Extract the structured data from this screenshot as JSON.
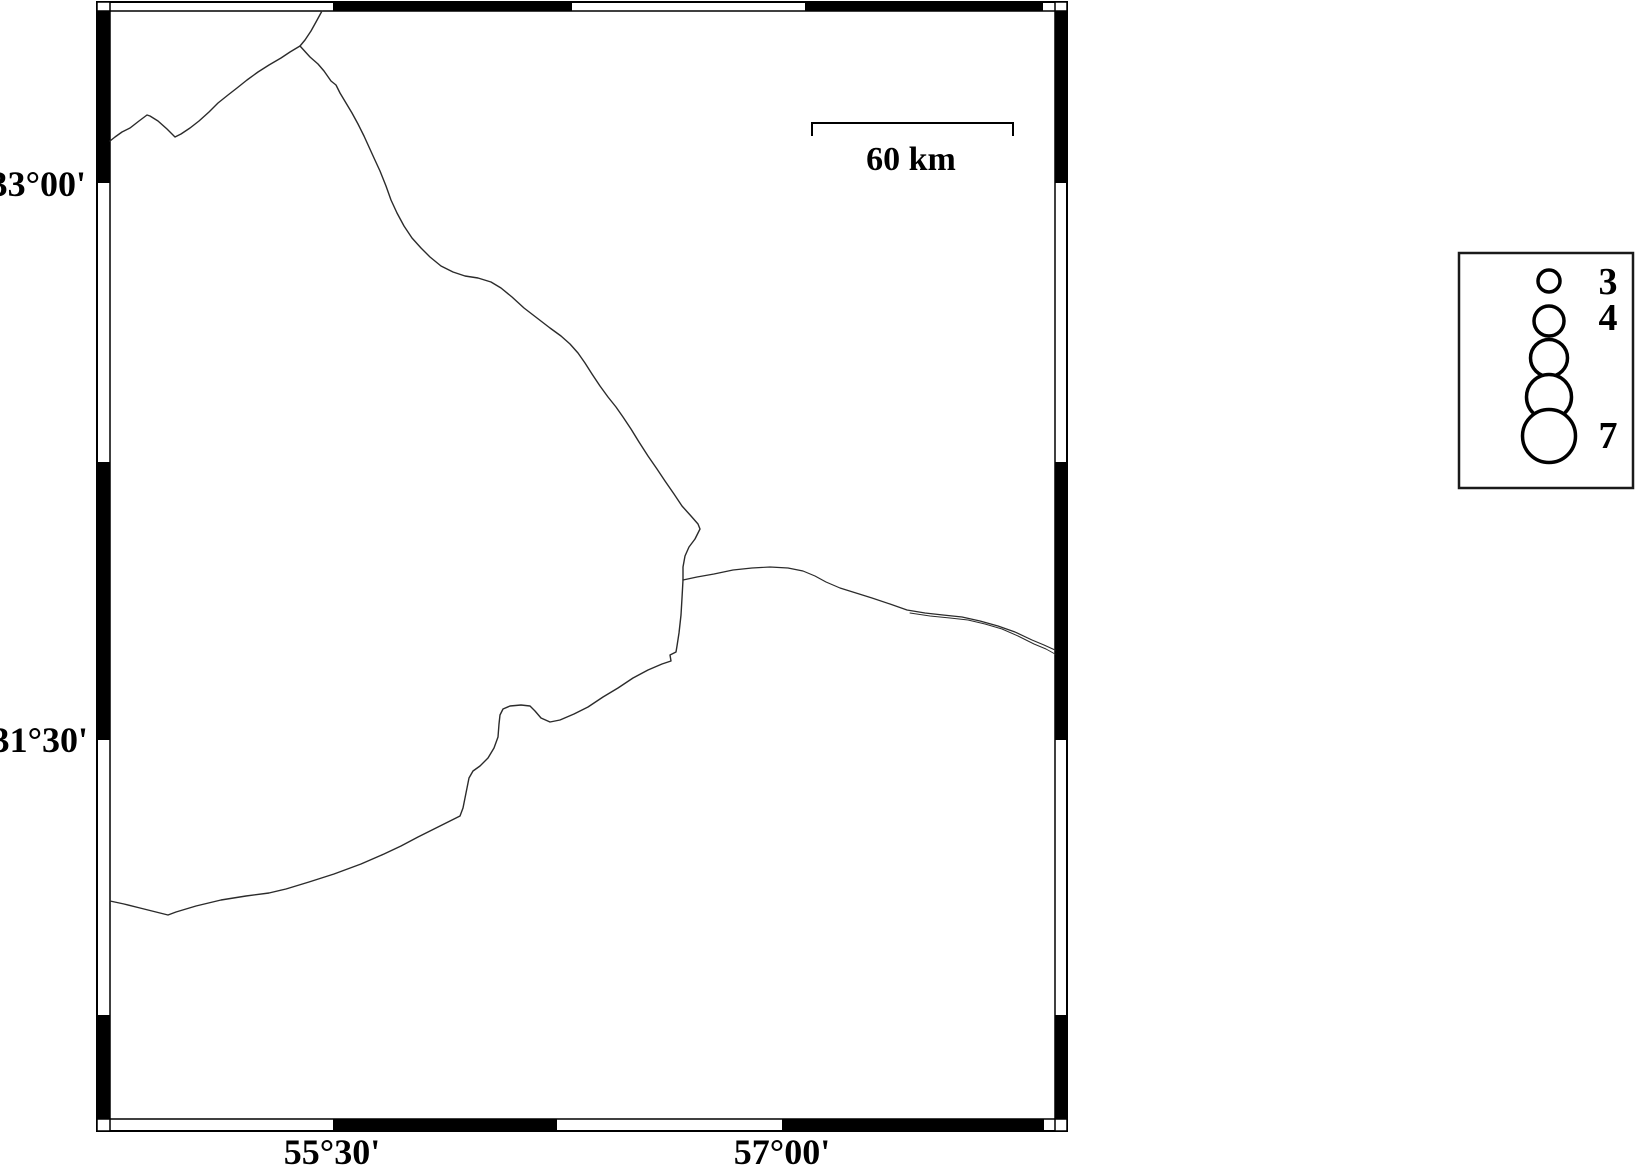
{
  "figure": {
    "width": 1639,
    "height": 1168,
    "background": "#ffffff",
    "frame_color": "#000000",
    "boundary_line_color": "#2b2b2b"
  },
  "map": {
    "frame": {
      "outer": {
        "x1": 97,
        "y1": 2,
        "x2": 1067,
        "y2": 1131
      },
      "inner": {
        "x1": 110,
        "y1": 11,
        "x2": 1055,
        "y2": 1119
      },
      "top_black_segments": [
        [
          333,
          572
        ],
        [
          805,
          1043
        ]
      ],
      "bottom_black_segments": [
        [
          333,
          557
        ],
        [
          782,
          1044
        ]
      ],
      "left_black_segments": [
        [
          11,
          183
        ],
        [
          462,
          740
        ],
        [
          1015,
          1119
        ]
      ],
      "right_black_segments": [
        [
          11,
          183
        ],
        [
          462,
          740
        ],
        [
          1015,
          1119
        ]
      ]
    },
    "graticule_labels": {
      "latitude": [
        {
          "text": "33°00'",
          "anchor_x": 86,
          "baseline_y": 196
        },
        {
          "text": "31°30'",
          "anchor_x": 88,
          "baseline_y": 752
        }
      ],
      "longitude": [
        {
          "text": "55°30'",
          "center_x": 332,
          "baseline_y": 1164
        },
        {
          "text": "57°00'",
          "center_x": 782,
          "baseline_y": 1164
        }
      ]
    },
    "scale_bar": {
      "label": "60 km",
      "x1": 812,
      "x2": 1013,
      "y": 123,
      "tick_drop": 13,
      "label_center_x": 911,
      "label_baseline_y": 170
    },
    "boundaries": {
      "northwest_line": [
        [
          322,
          11
        ],
        [
          316,
          22
        ],
        [
          311,
          31
        ],
        [
          305,
          40
        ],
        [
          300,
          46
        ],
        [
          290,
          52
        ],
        [
          281,
          58
        ],
        [
          269,
          65
        ],
        [
          258,
          72
        ],
        [
          247,
          80
        ],
        [
          237,
          88
        ],
        [
          228,
          95
        ],
        [
          218,
          103
        ],
        [
          209,
          112
        ],
        [
          199,
          121
        ],
        [
          190,
          128
        ],
        [
          181,
          134
        ],
        [
          175,
          137
        ],
        [
          167,
          129
        ],
        [
          158,
          121
        ],
        [
          150,
          116
        ],
        [
          147,
          115
        ],
        [
          139,
          121
        ],
        [
          130,
          128
        ],
        [
          122,
          132
        ],
        [
          115,
          137
        ],
        [
          110,
          141
        ]
      ],
      "long_diagonal": [
        [
          300,
          46
        ],
        [
          310,
          57
        ],
        [
          318,
          64
        ],
        [
          324,
          71
        ],
        [
          331,
          81
        ],
        [
          336,
          85
        ],
        [
          340,
          93
        ],
        [
          346,
          103
        ],
        [
          352,
          113
        ],
        [
          358,
          124
        ],
        [
          364,
          136
        ],
        [
          369,
          147
        ],
        [
          374,
          158
        ],
        [
          380,
          171
        ],
        [
          386,
          186
        ],
        [
          391,
          200
        ],
        [
          397,
          213
        ],
        [
          404,
          226
        ],
        [
          412,
          238
        ],
        [
          421,
          248
        ],
        [
          430,
          257
        ],
        [
          441,
          266
        ],
        [
          453,
          272
        ],
        [
          465,
          276
        ],
        [
          478,
          278
        ],
        [
          491,
          282
        ],
        [
          501,
          288
        ],
        [
          512,
          297
        ],
        [
          524,
          308
        ],
        [
          537,
          318
        ],
        [
          550,
          328
        ],
        [
          561,
          336
        ],
        [
          570,
          344
        ],
        [
          578,
          353
        ],
        [
          585,
          363
        ],
        [
          592,
          374
        ],
        [
          600,
          386
        ],
        [
          608,
          397
        ],
        [
          616,
          407
        ],
        [
          623,
          417
        ],
        [
          631,
          429
        ],
        [
          639,
          442
        ],
        [
          648,
          456
        ],
        [
          657,
          469
        ],
        [
          665,
          481
        ],
        [
          674,
          494
        ],
        [
          682,
          506
        ],
        [
          691,
          516
        ],
        [
          698,
          524
        ],
        [
          700,
          529
        ],
        [
          695,
          539
        ],
        [
          689,
          547
        ],
        [
          685,
          556
        ],
        [
          683,
          567
        ],
        [
          683,
          580
        ]
      ],
      "east_line": [
        [
          683,
          580
        ],
        [
          697,
          577
        ],
        [
          714,
          574
        ],
        [
          733,
          570
        ],
        [
          752,
          568
        ],
        [
          770,
          567
        ],
        [
          788,
          568
        ],
        [
          803,
          571
        ],
        [
          815,
          576
        ],
        [
          826,
          582
        ],
        [
          840,
          588
        ],
        [
          856,
          593
        ],
        [
          872,
          598
        ],
        [
          890,
          604
        ],
        [
          907,
          610
        ],
        [
          925,
          613
        ],
        [
          943,
          615
        ],
        [
          962,
          617
        ],
        [
          980,
          621
        ],
        [
          998,
          626
        ],
        [
          1015,
          632
        ],
        [
          1032,
          640
        ],
        [
          1044,
          645
        ],
        [
          1055,
          650
        ]
      ],
      "east_line_second_strand": [
        [
          910,
          613
        ],
        [
          930,
          616
        ],
        [
          950,
          618
        ],
        [
          968,
          620
        ],
        [
          985,
          624
        ],
        [
          1002,
          629
        ],
        [
          1018,
          636
        ],
        [
          1034,
          644
        ],
        [
          1046,
          649
        ],
        [
          1055,
          654
        ]
      ],
      "southwest_line": [
        [
          683,
          580
        ],
        [
          682,
          598
        ],
        [
          681,
          615
        ],
        [
          679,
          633
        ],
        [
          677,
          646
        ],
        [
          676,
          652
        ],
        [
          670,
          655
        ],
        [
          671,
          661
        ],
        [
          662,
          664
        ],
        [
          648,
          670
        ],
        [
          633,
          678
        ],
        [
          618,
          688
        ],
        [
          603,
          697
        ],
        [
          588,
          707
        ],
        [
          574,
          714
        ],
        [
          560,
          720
        ],
        [
          550,
          722
        ],
        [
          541,
          718
        ],
        [
          535,
          711
        ],
        [
          530,
          706
        ],
        [
          521,
          705
        ],
        [
          510,
          706
        ],
        [
          503,
          709
        ],
        [
          500,
          715
        ],
        [
          499,
          724
        ],
        [
          498,
          737
        ],
        [
          494,
          748
        ],
        [
          488,
          758
        ],
        [
          480,
          766
        ],
        [
          473,
          771
        ],
        [
          469,
          778
        ],
        [
          467,
          788
        ],
        [
          465,
          798
        ],
        [
          463,
          808
        ],
        [
          460,
          816
        ],
        [
          450,
          821
        ],
        [
          434,
          829
        ],
        [
          418,
          837
        ],
        [
          401,
          846
        ],
        [
          384,
          854
        ],
        [
          361,
          864
        ],
        [
          334,
          874
        ],
        [
          309,
          882
        ],
        [
          286,
          889
        ],
        [
          269,
          893
        ],
        [
          246,
          896
        ],
        [
          221,
          900
        ],
        [
          196,
          906
        ],
        [
          176,
          912
        ],
        [
          168,
          915
        ],
        [
          156,
          912
        ],
        [
          140,
          908
        ],
        [
          124,
          904
        ],
        [
          110,
          901
        ]
      ]
    }
  },
  "legend": {
    "box": {
      "x": 1459,
      "y": 253,
      "w": 174,
      "h": 235
    },
    "symbol_cx": 1549,
    "label_cx": 1608,
    "circle_stroke_width": 3.5,
    "items": [
      {
        "magnitude": "3",
        "cy": 281,
        "r": 11,
        "label_baseline_y": 294
      },
      {
        "magnitude": "4",
        "cy": 321,
        "r": 15,
        "label_baseline_y": 330
      },
      {
        "magnitude": "",
        "cy": 358,
        "r": 18.5,
        "label_baseline_y": 0
      },
      {
        "magnitude": "",
        "cy": 397,
        "r": 22.5,
        "label_baseline_y": 0
      },
      {
        "magnitude": "7",
        "cy": 436,
        "r": 26.5,
        "label_baseline_y": 448
      }
    ]
  }
}
